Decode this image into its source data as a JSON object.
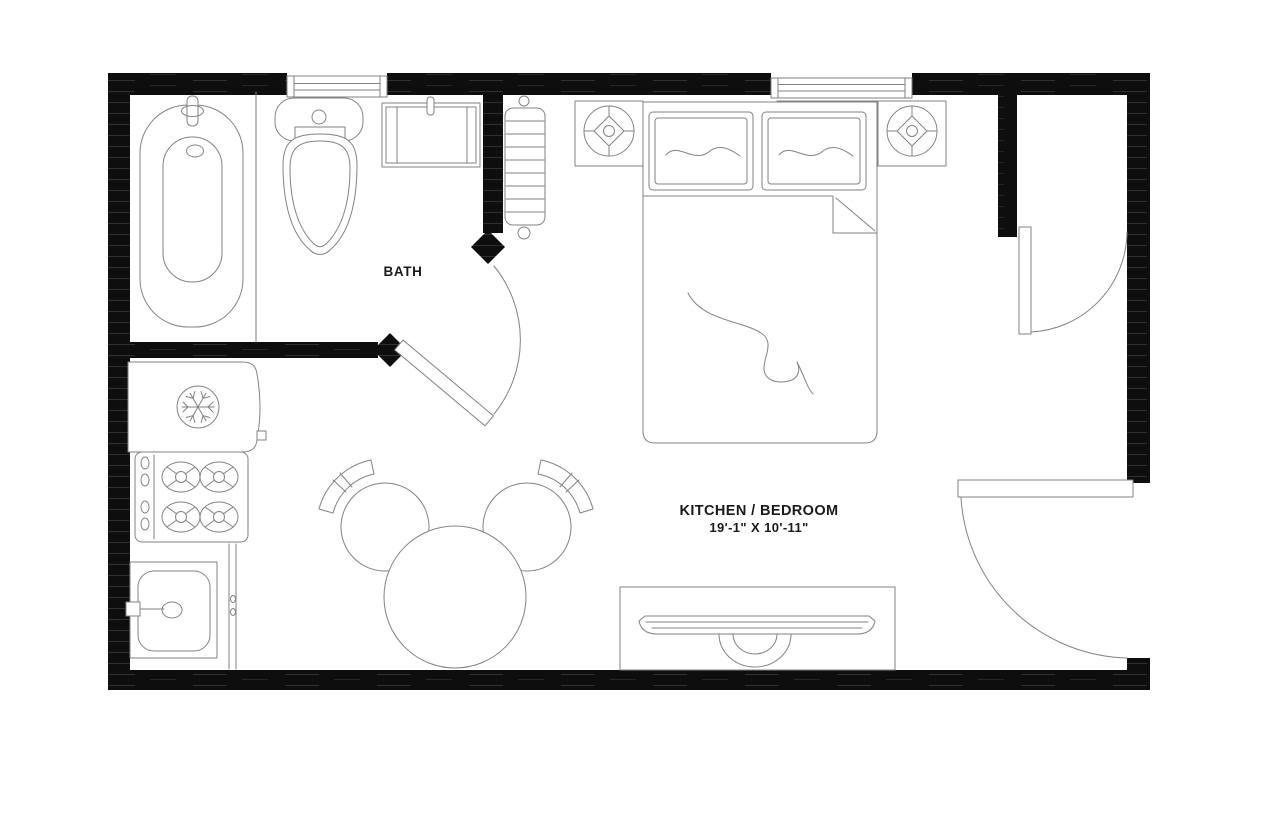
{
  "document": {
    "type": "floor-plan",
    "style": "top-down architectural drawing, black walls on white"
  },
  "colors": {
    "paper": "#ffffff",
    "wall": "#0e0e0e",
    "line": "#828282",
    "text": "#1a1a1a"
  },
  "labels": {
    "bath": {
      "name": "BATH"
    },
    "main_room": {
      "name": "KITCHEN / BEDROOM",
      "dimensions": "19'-1\" X 10'-11\""
    }
  },
  "rooms": [
    {
      "name": "BATH",
      "fixtures": [
        "bathtub",
        "toilet",
        "vanity-sink",
        "swing-door"
      ]
    },
    {
      "name": "KITCHEN / BEDROOM",
      "dimensions": "19'-1\" X 10'-11\"",
      "fixtures": [
        "radiator",
        "refrigerator",
        "stove-4-burners",
        "kitchen-sink",
        "counter",
        "round-dining-table",
        "chair-left",
        "chair-right",
        "double-bed",
        "pillow-left",
        "pillow-right",
        "nightstand-speaker-left",
        "nightstand-speaker-right",
        "media-console-tv",
        "closet-door",
        "entry-door"
      ]
    }
  ],
  "openings": {
    "windows": [
      "bath-window-top-left",
      "bedroom-window-top-center"
    ],
    "doors": [
      "bath-door",
      "closet-door",
      "entry-door"
    ]
  }
}
